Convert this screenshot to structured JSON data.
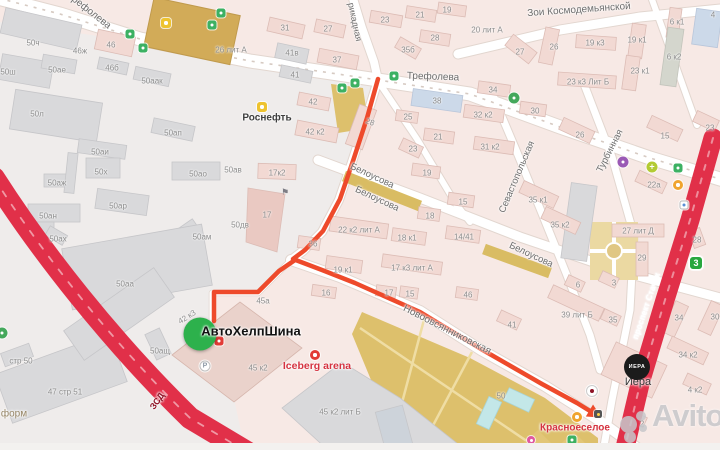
{
  "map": {
    "colors": {
      "route": "#ee4a2b",
      "highway": "#e13049",
      "marker": "#2db14c"
    },
    "street_labels": [
      {
        "name": "street-label-trefoleva-nw",
        "text": "Трефолева",
        "x": 89,
        "y": 11,
        "rot": 38,
        "size": 10
      },
      {
        "name": "street-label-trefoleva",
        "text": "Трефолева",
        "x": 433,
        "y": 77,
        "rot": 2,
        "size": 10
      },
      {
        "name": "street-label-barrikadnaya",
        "text": "рикадная",
        "x": 355,
        "y": 22,
        "rot": 78,
        "size": 9
      },
      {
        "name": "street-label-zoi-kosmodemyanskoy",
        "text": "Зои Космодемьянской",
        "x": 579,
        "y": 10,
        "rot": -4,
        "size": 10
      },
      {
        "name": "street-label-belousova-1",
        "text": "Белоусова",
        "x": 372,
        "y": 176,
        "rot": 25,
        "size": 9.5
      },
      {
        "name": "street-label-belousova-2",
        "text": "Белоусова",
        "x": 377,
        "y": 199,
        "rot": 25,
        "size": 9.5
      },
      {
        "name": "street-label-belousova-3",
        "text": "Белоусова",
        "x": 531,
        "y": 255,
        "rot": 25,
        "size": 9.5
      },
      {
        "name": "street-label-sevastopolskaya",
        "text": "Севастопольская",
        "x": 517,
        "y": 177,
        "rot": -67,
        "size": 9.5
      },
      {
        "name": "street-label-turbinnaya",
        "text": "Турбинная",
        "x": 610,
        "y": 151,
        "rot": -63,
        "size": 9.5
      },
      {
        "name": "street-label-novoovsyannikovskaya",
        "text": "Новоовсянниковская",
        "x": 447,
        "y": 330,
        "rot": 27,
        "size": 10
      },
      {
        "name": "street-label-zsd",
        "text": "ЗСД",
        "x": 157,
        "y": 401,
        "rot": -55,
        "size": 9,
        "color": "#8e1326",
        "weight": "bold"
      },
      {
        "name": "street-label-prospekt-stachek",
        "text": "проспект Стачек",
        "x": 646,
        "y": 306,
        "rot": -71,
        "size": 8.5,
        "color": "#ffffff",
        "weight": "600"
      }
    ],
    "building_labels": [
      {
        "text": "50ч",
        "x": 33,
        "y": 43
      },
      {
        "text": "50ш",
        "x": 8,
        "y": 72
      },
      {
        "text": "50ае",
        "x": 57,
        "y": 70
      },
      {
        "text": "46ж",
        "x": 80,
        "y": 51
      },
      {
        "text": "46",
        "x": 111,
        "y": 45
      },
      {
        "text": "46б",
        "x": 112,
        "y": 68
      },
      {
        "text": "50аак",
        "x": 152,
        "y": 81
      },
      {
        "text": "50л",
        "x": 37,
        "y": 114
      },
      {
        "text": "50ап",
        "x": 173,
        "y": 133
      },
      {
        "text": "26 лит А",
        "x": 231,
        "y": 50
      },
      {
        "text": "50аи",
        "x": 100,
        "y": 152
      },
      {
        "text": "50х",
        "x": 101,
        "y": 172
      },
      {
        "text": "50аж",
        "x": 57,
        "y": 183
      },
      {
        "text": "50ао",
        "x": 198,
        "y": 174
      },
      {
        "text": "50ав",
        "x": 233,
        "y": 170
      },
      {
        "text": "50ар",
        "x": 118,
        "y": 206
      },
      {
        "text": "50ан",
        "x": 48,
        "y": 216
      },
      {
        "text": "50ах",
        "x": 58,
        "y": 239
      },
      {
        "text": "50ам",
        "x": 202,
        "y": 237
      },
      {
        "text": "50аа",
        "x": 125,
        "y": 284
      },
      {
        "text": "50дв",
        "x": 240,
        "y": 225
      },
      {
        "text": "стр 50",
        "x": 21,
        "y": 361
      },
      {
        "text": "47 стр 51",
        "x": 65,
        "y": 392
      },
      {
        "text": "50ащ",
        "x": 160,
        "y": 351
      },
      {
        "text": "42 к3",
        "x": 187,
        "y": 317,
        "rot": -32
      },
      {
        "text": "45а",
        "x": 263,
        "y": 301
      },
      {
        "text": "45 к2",
        "x": 258,
        "y": 368
      },
      {
        "text": "45 к2 лит Б",
        "x": 340,
        "y": 412
      },
      {
        "text": "31",
        "x": 285,
        "y": 28
      },
      {
        "text": "27",
        "x": 328,
        "y": 29
      },
      {
        "text": "23",
        "x": 385,
        "y": 20
      },
      {
        "text": "21",
        "x": 420,
        "y": 15
      },
      {
        "text": "19",
        "x": 447,
        "y": 10
      },
      {
        "text": "28",
        "x": 435,
        "y": 38
      },
      {
        "text": "35б",
        "x": 408,
        "y": 50
      },
      {
        "text": "37",
        "x": 337,
        "y": 60
      },
      {
        "text": "41в",
        "x": 292,
        "y": 53
      },
      {
        "text": "41",
        "x": 295,
        "y": 75
      },
      {
        "text": "42",
        "x": 313,
        "y": 102
      },
      {
        "text": "42 к2",
        "x": 315,
        "y": 132
      },
      {
        "text": "28",
        "x": 370,
        "y": 122,
        "rot": 20
      },
      {
        "text": "38",
        "x": 437,
        "y": 101
      },
      {
        "text": "25",
        "x": 408,
        "y": 117
      },
      {
        "text": "21",
        "x": 438,
        "y": 137
      },
      {
        "text": "23",
        "x": 413,
        "y": 149
      },
      {
        "text": "19",
        "x": 427,
        "y": 173
      },
      {
        "text": "15",
        "x": 463,
        "y": 202
      },
      {
        "text": "32 к2",
        "x": 483,
        "y": 115
      },
      {
        "text": "30",
        "x": 535,
        "y": 111
      },
      {
        "text": "34",
        "x": 493,
        "y": 90
      },
      {
        "text": "31 к2",
        "x": 490,
        "y": 147
      },
      {
        "text": "20 лит А",
        "x": 487,
        "y": 30
      },
      {
        "text": "27",
        "x": 520,
        "y": 52
      },
      {
        "text": "26",
        "x": 554,
        "y": 47
      },
      {
        "text": "19 к3",
        "x": 595,
        "y": 43
      },
      {
        "text": "19 к1",
        "x": 637,
        "y": 40
      },
      {
        "text": "6 к1",
        "x": 677,
        "y": 22
      },
      {
        "text": "4",
        "x": 713,
        "y": 15
      },
      {
        "text": "6 к2",
        "x": 674,
        "y": 57
      },
      {
        "text": "23 к1",
        "x": 640,
        "y": 71
      },
      {
        "text": "23 к3 Лит Б",
        "x": 588,
        "y": 82
      },
      {
        "text": "26",
        "x": 580,
        "y": 135
      },
      {
        "text": "15",
        "x": 665,
        "y": 136
      },
      {
        "text": "23",
        "x": 710,
        "y": 128
      },
      {
        "text": "22а",
        "x": 654,
        "y": 185
      },
      {
        "text": "35 к1",
        "x": 538,
        "y": 200
      },
      {
        "text": "35 к2",
        "x": 560,
        "y": 225
      },
      {
        "text": "17к2",
        "x": 277,
        "y": 173
      },
      {
        "text": "17",
        "x": 267,
        "y": 215
      },
      {
        "text": "22 к2 лит А",
        "x": 359,
        "y": 230
      },
      {
        "text": "36",
        "x": 313,
        "y": 244
      },
      {
        "text": "19 к1",
        "x": 343,
        "y": 270
      },
      {
        "text": "18",
        "x": 430,
        "y": 216
      },
      {
        "text": "18 к1",
        "x": 407,
        "y": 238
      },
      {
        "text": "14/41",
        "x": 464,
        "y": 237
      },
      {
        "text": "17 к3 лит А",
        "x": 412,
        "y": 268
      },
      {
        "text": "16",
        "x": 326,
        "y": 293
      },
      {
        "text": "17",
        "x": 389,
        "y": 293
      },
      {
        "text": "15",
        "x": 410,
        "y": 294
      },
      {
        "text": "46",
        "x": 468,
        "y": 295
      },
      {
        "text": "27 лит Д",
        "x": 638,
        "y": 231
      },
      {
        "text": "28",
        "x": 697,
        "y": 240
      },
      {
        "text": "29",
        "x": 642,
        "y": 258
      },
      {
        "text": "6",
        "x": 578,
        "y": 285
      },
      {
        "text": "3",
        "x": 614,
        "y": 283
      },
      {
        "text": "39 лит Б",
        "x": 577,
        "y": 315
      },
      {
        "text": "41",
        "x": 512,
        "y": 325
      },
      {
        "text": "35",
        "x": 613,
        "y": 320
      },
      {
        "text": "34",
        "x": 679,
        "y": 318
      },
      {
        "text": "30",
        "x": 715,
        "y": 317
      },
      {
        "text": "34 к2",
        "x": 688,
        "y": 355
      },
      {
        "text": "4 к2",
        "x": 695,
        "y": 390
      },
      {
        "text": "2",
        "x": 642,
        "y": 424
      },
      {
        "text": "50",
        "x": 501,
        "y": 396
      }
    ],
    "pois": [
      {
        "name": "poi-rosneft",
        "text": "Роснефть",
        "x": 267,
        "y": 118,
        "color": "#3f3f3f",
        "size": 10,
        "weight": "bold"
      },
      {
        "name": "poi-iceberg-arena",
        "text": "Iceberg arena",
        "x": 317,
        "y": 366,
        "color": "#d53340",
        "size": 10.5,
        "weight": "bold"
      },
      {
        "name": "poi-krasnoeseloe",
        "text": "Красноеселое",
        "x": 575,
        "y": 428,
        "color": "#d53340",
        "size": 10,
        "weight": "600"
      },
      {
        "name": "poi-ivera-label",
        "text": "Иера",
        "x": 638,
        "y": 382,
        "color": "#333333",
        "size": 11,
        "weight": "500"
      },
      {
        "name": "poi-form",
        "text": "форм",
        "x": 14,
        "y": 414,
        "color": "#968565",
        "size": 10,
        "weight": "normal"
      }
    ],
    "marker": {
      "label": "АвтоХелпШина",
      "x": 200,
      "y": 334,
      "d": 33,
      "label_x": 251,
      "label_y": 331,
      "label_size": 13
    },
    "ivera_logo": {
      "text": "ИЕРА",
      "x": 637,
      "y": 367,
      "d": 26,
      "font": 5.5
    },
    "watermark": {
      "text": "Avito",
      "x": 610,
      "y": 398
    },
    "icons": [
      {
        "name": "transit-stop-icon",
        "x": 342,
        "y": 88,
        "bg": "#3cb163",
        "shape": "sq",
        "size": 9,
        "dot": 1
      },
      {
        "name": "transit-stop-icon",
        "x": 355,
        "y": 83,
        "bg": "#3cb163",
        "shape": "sq",
        "size": 9,
        "dot": 1
      },
      {
        "name": "transit-stop-icon",
        "x": 394,
        "y": 76,
        "bg": "#3cb163",
        "shape": "sq",
        "size": 9,
        "dot": 1
      },
      {
        "name": "transit-stop-icon",
        "x": 130,
        "y": 34,
        "bg": "#3cb163",
        "shape": "sq",
        "size": 9,
        "dot": 1
      },
      {
        "name": "transit-stop-icon",
        "x": 143,
        "y": 48,
        "bg": "#3cb163",
        "shape": "sq",
        "size": 9,
        "dot": 1
      },
      {
        "name": "transit-stop-icon",
        "x": 212,
        "y": 25,
        "bg": "#3cb163",
        "shape": "sq",
        "size": 9,
        "dot": 1
      },
      {
        "name": "transit-stop-icon",
        "x": 221,
        "y": 13,
        "bg": "#3cb163",
        "shape": "sq",
        "size": 9,
        "dot": 1
      },
      {
        "name": "transit-stop-icon",
        "x": 678,
        "y": 168,
        "bg": "#3cb163",
        "shape": "sq",
        "size": 9,
        "dot": 1
      },
      {
        "name": "transit-stop-icon",
        "x": 572,
        "y": 440,
        "bg": "#3cb163",
        "shape": "sq",
        "size": 9,
        "dot": 1
      },
      {
        "name": "transit-stop-white-icon",
        "x": 684,
        "y": 205,
        "bg": "#ffffff",
        "shape": "sq",
        "size": 9,
        "dot": 1,
        "dotc": "#5b8fd6",
        "border": "1px solid #bbb"
      },
      {
        "name": "fuel-station-icon",
        "x": 166,
        "y": 23,
        "bg": "#eec32f",
        "shape": "sq",
        "size": 10,
        "dot": 1
      },
      {
        "name": "fuel-station-icon",
        "x": 262,
        "y": 107,
        "bg": "#eec32f",
        "shape": "sq",
        "size": 10,
        "dot": 1
      },
      {
        "name": "shopping-cart-icon",
        "x": 678,
        "y": 185,
        "bg": "#f0a42e",
        "shape": "circle",
        "size": 10,
        "dot": 1
      },
      {
        "name": "shopping-cart-icon",
        "x": 577,
        "y": 417,
        "bg": "#f0a42e",
        "shape": "circle",
        "size": 10,
        "dot": 1
      },
      {
        "name": "pharmacy-cross-icon",
        "x": 652,
        "y": 167,
        "bg": "#b3cb33",
        "shape": "circle",
        "size": 11,
        "glyph": "+",
        "glyph_color": "#ffffff",
        "fs": 9
      },
      {
        "name": "park-icon",
        "x": 514,
        "y": 98,
        "bg": "#44a85c",
        "shape": "circle",
        "size": 11,
        "dot": 1
      },
      {
        "name": "park-icon",
        "x": 2,
        "y": 333,
        "bg": "#44a85c",
        "shape": "circle",
        "size": 11,
        "dot": 1
      },
      {
        "name": "theater-icon",
        "x": 623,
        "y": 162,
        "bg": "#9a59b5",
        "shape": "circle",
        "size": 11,
        "dot": 1
      },
      {
        "name": "tram-route-3-badge",
        "x": 696,
        "y": 263,
        "bg": "#28a73e",
        "shape": "sq",
        "size": 14,
        "glyph": "3",
        "glyph_color": "#ffffff",
        "fs": 9,
        "border": "1.5px solid #ffffff"
      },
      {
        "name": "parking-icon",
        "x": 205,
        "y": 366,
        "bg": "#ffffff",
        "shape": "circle",
        "size": 11,
        "glyph": "P",
        "glyph_color": "#8f9aa6",
        "fs": 7,
        "border": "1px solid #c0c0c0"
      },
      {
        "name": "flag-icon",
        "x": 285,
        "y": 192,
        "bg": "transparent",
        "shape": "sq",
        "size": 10,
        "glyph": "⚑",
        "glyph_color": "#7d7d85",
        "fs": 9
      },
      {
        "name": "traffic-light-icon",
        "x": 598,
        "y": 414,
        "bg": "#555555",
        "shape": "sq",
        "size": 8,
        "dot": 1,
        "dotc": "#ffd24a"
      },
      {
        "name": "poi-dot-icon",
        "x": 531,
        "y": 440,
        "bg": "#e058a0",
        "shape": "circle",
        "size": 8,
        "dot": 1
      },
      {
        "name": "tire-service-icon",
        "x": 219,
        "y": 341,
        "bg": "#e23b36",
        "shape": "sq",
        "size": 9,
        "dot": 1
      },
      {
        "name": "iceberg-arena-icon",
        "x": 315,
        "y": 355,
        "bg": "#e23b36",
        "shape": "circle",
        "size": 10,
        "dot": 1
      },
      {
        "name": "crossing-icon",
        "x": 592,
        "y": 391,
        "bg": "#ffffff",
        "shape": "circle",
        "size": 12,
        "dot": 1,
        "dotc": "#8e1326",
        "border": "1px solid #ccc"
      }
    ]
  }
}
